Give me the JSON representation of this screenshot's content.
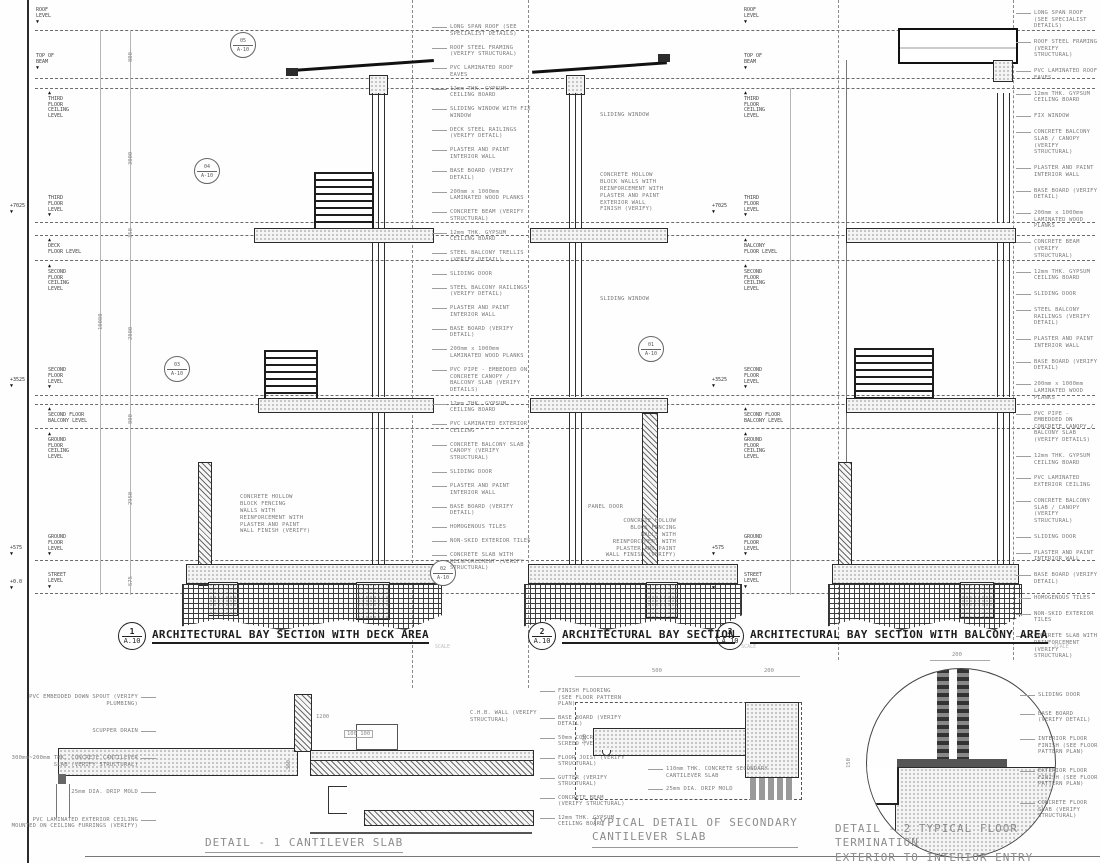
{
  "levels": {
    "left": [
      {
        "elev": "",
        "label": "ROOF\nLEVEL"
      },
      {
        "elev": "",
        "label": "TOP OF\nBEAM"
      },
      {
        "elev": "",
        "label": "THIRD\nFLOOR\nCEILING\nLEVEL"
      },
      {
        "elev": "+7025",
        "label": "THIRD\nFLOOR\nLEVEL"
      },
      {
        "elev": "",
        "label": "DECK\nFLOOR LEVEL"
      },
      {
        "elev": "",
        "label": "SECOND\nFLOOR\nCEILING\nLEVEL"
      },
      {
        "elev": "+3525",
        "label": "SECOND\nFLOOR\nLEVEL"
      },
      {
        "elev": "",
        "label": "SECOND FLOOR\nBALCONY LEVEL"
      },
      {
        "elev": "",
        "label": "GROUND\nFLOOR\nCEILING\nLEVEL"
      },
      {
        "elev": "+575",
        "label": "GROUND\nFLOOR\nLEVEL"
      },
      {
        "elev": "+0.0",
        "label": "STREET\nLEVEL"
      }
    ],
    "mid": [
      {
        "elev": "",
        "label": "ROOF\nLEVEL"
      },
      {
        "elev": "",
        "label": "TOP OF\nBEAM"
      },
      {
        "elev": "",
        "label": "THIRD\nFLOOR\nCEILING\nLEVEL"
      },
      {
        "elev": "+7025",
        "label": "THIRD\nFLOOR\nLEVEL"
      },
      {
        "elev": "",
        "label": "BALCONY\nFLOOR LEVEL"
      },
      {
        "elev": "",
        "label": "SECOND\nFLOOR\nCEILING\nLEVEL"
      },
      {
        "elev": "+3525",
        "label": "SECOND\nFLOOR\nLEVEL"
      },
      {
        "elev": "",
        "label": "SECOND FLOOR\nBALCONY LEVEL"
      },
      {
        "elev": "",
        "label": "GROUND\nFLOOR\nCEILING\nLEVEL"
      },
      {
        "elev": "+575",
        "label": "GROUND\nFLOOR\nLEVEL"
      },
      {
        "elev": "+0.0",
        "label": "STREET\nLEVEL"
      }
    ]
  },
  "dims": {
    "left_chain": [
      "800",
      "3000",
      "350",
      "2800",
      "800",
      "2950",
      "575"
    ],
    "overall": "10080",
    "d1": {
      "top": "1200",
      "pair": "100   100",
      "height": "300"
    },
    "dsec": {
      "a": "500",
      "b": "200",
      "h": "100"
    },
    "d2": {
      "top": "200",
      "h": "150"
    }
  },
  "ann_center": [
    "LONG SPAN ROOF (SEE SPECIALIST DETAILS)",
    "ROOF STEEL FRAMING (VERIFY STRUCTURAL)",
    "PVC LAMINATED ROOF EAVES",
    "12mm THK. GYPSUM CEILING BOARD",
    "SLIDING WINDOW WITH FIX WINDOW",
    "DECK STEEL RAILINGS (VERIFY DETAIL)",
    "PLASTER AND PAINT INTERIOR WALL",
    "BASE BOARD (VERIFY DETAIL)",
    "200mm x 1000mm LAMINATED WOOD PLANKS",
    "CONCRETE BEAM (VERIFY STRUCTURAL)",
    "12mm THK. GYPSUM CEILING BOARD",
    "STEEL BALCONY TRELLIS (VERIFY DETAIL)",
    "SLIDING DOOR",
    "STEEL BALCONY RAILINGS (VERIFY DETAIL)",
    "PLASTER AND PAINT INTERIOR WALL",
    "BASE BOARD (VERIFY DETAIL)",
    "200mm x 1000mm LAMINATED WOOD PLANKS",
    "PVC PIPE - EMBEDDED ON CONCRETE CANOPY / BALCONY SLAB (VERIFY DETAILS)",
    "12mm THK. GYPSUM CEILING BOARD",
    "PVC LAMINATED EXTERIOR CEILING",
    "CONCRETE BALCONY SLAB / CANOPY (VERIFY STRUCTURAL)",
    "SLIDING DOOR",
    "PLASTER AND PAINT INTERIOR WALL",
    "BASE BOARD (VERIFY DETAIL)",
    "HOMOGENOUS TILES",
    "NON-SKID EXTERIOR TILES",
    "CONCRETE SLAB WITH REINFORCEMENT (VERIFY STRUCTURAL)"
  ],
  "ann_right": [
    "LONG SPAN ROOF (SEE SPECIALIST DETAILS)",
    "ROOF STEEL FRAMING (VERIFY STRUCTURAL)",
    "PVC LAMINATED ROOF EAVES",
    "12mm THK. GYPSUM CEILING BOARD",
    "FIX WINDOW",
    "CONCRETE BALCONY SLAB / CANOPY (VERIFY STRUCTURAL)",
    "PLASTER AND PAINT INTERIOR WALL",
    "BASE BOARD (VERIFY DETAIL)",
    "200mm x 1000mm LAMINATED WOOD PLANKS",
    "CONCRETE BEAM (VERIFY STRUCTURAL)",
    "12mm THK. GYPSUM CEILING BOARD",
    "SLIDING DOOR",
    "STEEL BALCONY RAILINGS (VERIFY DETAIL)",
    "PLASTER AND PAINT INTERIOR WALL",
    "BASE BOARD (VERIFY DETAIL)",
    "200mm x 1000mm LAMINATED WOOD PLANKS",
    "PVC PIPE - EMBEDDED ON CONCRETE CANOPY / BALCONY SLAB (VERIFY DETAILS)",
    "12mm THK. GYPSUM CEILING BOARD",
    "PVC LAMINATED EXTERIOR CEILING",
    "CONCRETE BALCONY SLAB / CANOPY (VERIFY STRUCTURAL)",
    "SLIDING DOOR",
    "PLASTER AND PAINT INTERIOR WALL",
    "BASE BOARD (VERIFY DETAIL)",
    "HOMOGENOUS TILES",
    "NON-SKID EXTERIOR TILES",
    "CONCRETE SLAB WITH REINFORCEMENT (VERIFY STRUCTURAL)"
  ],
  "sec1": {
    "body": "CONCRETE HOLLOW\nBLOCK FENCING\nWALLS WITH\nREINFORCEMENT WITH\nPLASTER AND PAINT\nWALL FINISH (VERIFY)"
  },
  "sec2": {
    "window_upper": "SLIDING WINDOW",
    "wall_ext": "CONCRETE HOLLOW\nBLOCK WALLS WITH\nREINFORCEMENT WITH\nPLASTER AND PAINT\nEXTERIOR WALL\nFINISH (VERIFY)",
    "window_lower": "SLIDING WINDOW",
    "panel_door": "PANEL DOOR",
    "body": "CONCRETE HOLLOW\nBLOCK FENCING\nWALLS WITH\nREINFORCEMENT WITH\nPLASTER AND PAINT\nWALL FINISH (VERIFY)"
  },
  "detail1": {
    "left": [
      "PVC EMBEDDED DOWN SPOUT (VERIFY PLUMBING)",
      "SCUPPER DRAIN",
      "300mm~200mm THK. CONCRETE CANTILEVER SLAB (VERIFY STRUCTURAL)",
      "25mm DIA. DRIP MOLD",
      "PVC LAMINATED EXTERIOR CEILING MOUNTED ON CEILING FURRINGS (VERIFY)"
    ],
    "top": "C.H.B. WALL (VERIFY\nSTRUCTURAL)",
    "right": [
      "FINISH FLOORING (SEE FLOOR PATTERN PLAN)",
      "BASE BOARD (VERIFY DETAIL)",
      "50mm CONCRETE SCREED (VERIFY)",
      "FLOOR JOIST (VERIFY STRUCTURAL)",
      "GUTTER (VERIFY STRUCTURAL)",
      "CONCRETE BEAM (VERIFY STRUCTURAL)",
      "12mm THK. GYPSUM CEILING BOARD"
    ]
  },
  "dsec_labels": [
    "110mm THK. CONCRETE SECONDARY CANTILEVER SLAB",
    "25mm DIA. DRIP MOLD"
  ],
  "d2_labels": [
    "SLIDING DOOR",
    "BASE BOARD (VERIFY DETAIL)",
    "INTERIOR FLOOR FINISH (SEE FLOOR PATTERN PLAN)",
    "EXTERIOR FLOOR FINISH (SEE FLOOR PATTERN PLAN)",
    "CONCRETE FLOOR SLAB (VERIFY STRUCTURAL)"
  ],
  "callouts": [
    {
      "num": "05",
      "sheet": "A-10"
    },
    {
      "num": "04",
      "sheet": "A-10"
    },
    {
      "num": "03",
      "sheet": "A-10"
    },
    {
      "num": "01",
      "sheet": "A-10"
    },
    {
      "num": "02",
      "sheet": "A-10"
    }
  ],
  "titles": {
    "s1": {
      "num": "1",
      "sheet": "A.10",
      "label": "ARCHITECTURAL BAY SECTION WITH DECK AREA",
      "scale": "SCALE"
    },
    "s2": {
      "num": "2",
      "sheet": "A.10",
      "label": "ARCHITECTURAL BAY SECTION",
      "scale": "SCALE"
    },
    "s3": {
      "num": "3",
      "sheet": "A.10",
      "label": "ARCHITECTURAL BAY SECTION WITH BALCONY AREA",
      "scale": "SCALE"
    },
    "d1": {
      "label": "DETAIL - 1 CANTILEVER SLAB"
    },
    "dsec": {
      "label": "TYPICAL DETAIL OF SECONDARY\nCANTILEVER SLAB"
    },
    "d2": {
      "label": "DETAIL - 2 TYPICAL FLOOR TERMINATION\nEXTERIOR TO INTERIOR ENTRY"
    }
  }
}
